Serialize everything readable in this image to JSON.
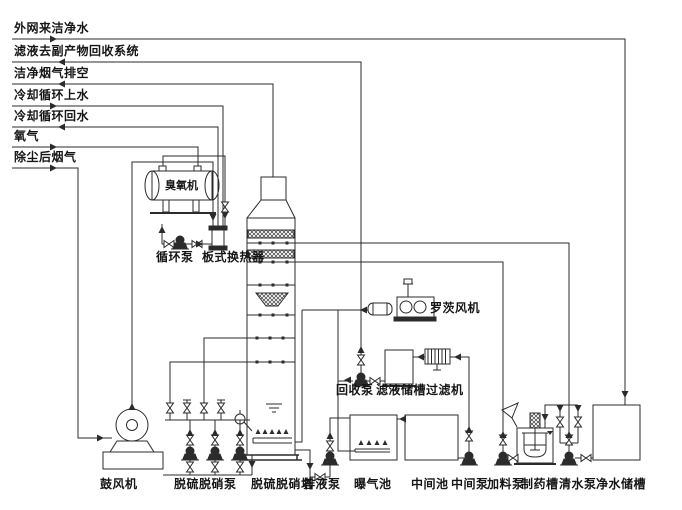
{
  "diagram": {
    "type": "process-flow-diagram",
    "colors": {
      "background": "#ffffff",
      "line": "#2b2b2b",
      "text": "#161616"
    },
    "feed_lines": [
      {
        "id": "external-clean-water",
        "label": "外网来洁净水",
        "direction": "in"
      },
      {
        "id": "filtrate-to-byproduct",
        "label": "滤液去副产物回收系统",
        "direction": "out"
      },
      {
        "id": "clean-flue-gas-vent",
        "label": "洁净烟气排空",
        "direction": "out"
      },
      {
        "id": "cooling-cycle-supply",
        "label": "冷却循环上水",
        "direction": "in"
      },
      {
        "id": "cooling-cycle-return",
        "label": "冷却循环回水",
        "direction": "out"
      },
      {
        "id": "oxygen",
        "label": "氧气",
        "direction": "in"
      },
      {
        "id": "dedusted-flue-gas",
        "label": "除尘后烟气",
        "direction": "in"
      }
    ],
    "equipment": {
      "ozone_machine": "臭氧机",
      "circulation_pump": "循环泵",
      "plate_heat_exchanger": "板式换热器",
      "roots_blower": "罗茨风机",
      "recovery_pump": "回收泵",
      "filtrate_tank": "滤液储槽",
      "filter": "过滤机",
      "blower": "鼓风机",
      "desulf_denitr_pump": "脱硫脱硝泵",
      "desulf_denitr_tower": "脱硫脱硝塔",
      "drain_pump": "排液泵",
      "aeration_pool": "曝气池",
      "intermediate_pool": "中间池",
      "intermediate_pump": "中间泵",
      "feed_pump": "加料泵",
      "dosing_tank": "制药槽",
      "clean_water_pump": "清水泵",
      "clean_water_tank": "净水储槽"
    }
  }
}
